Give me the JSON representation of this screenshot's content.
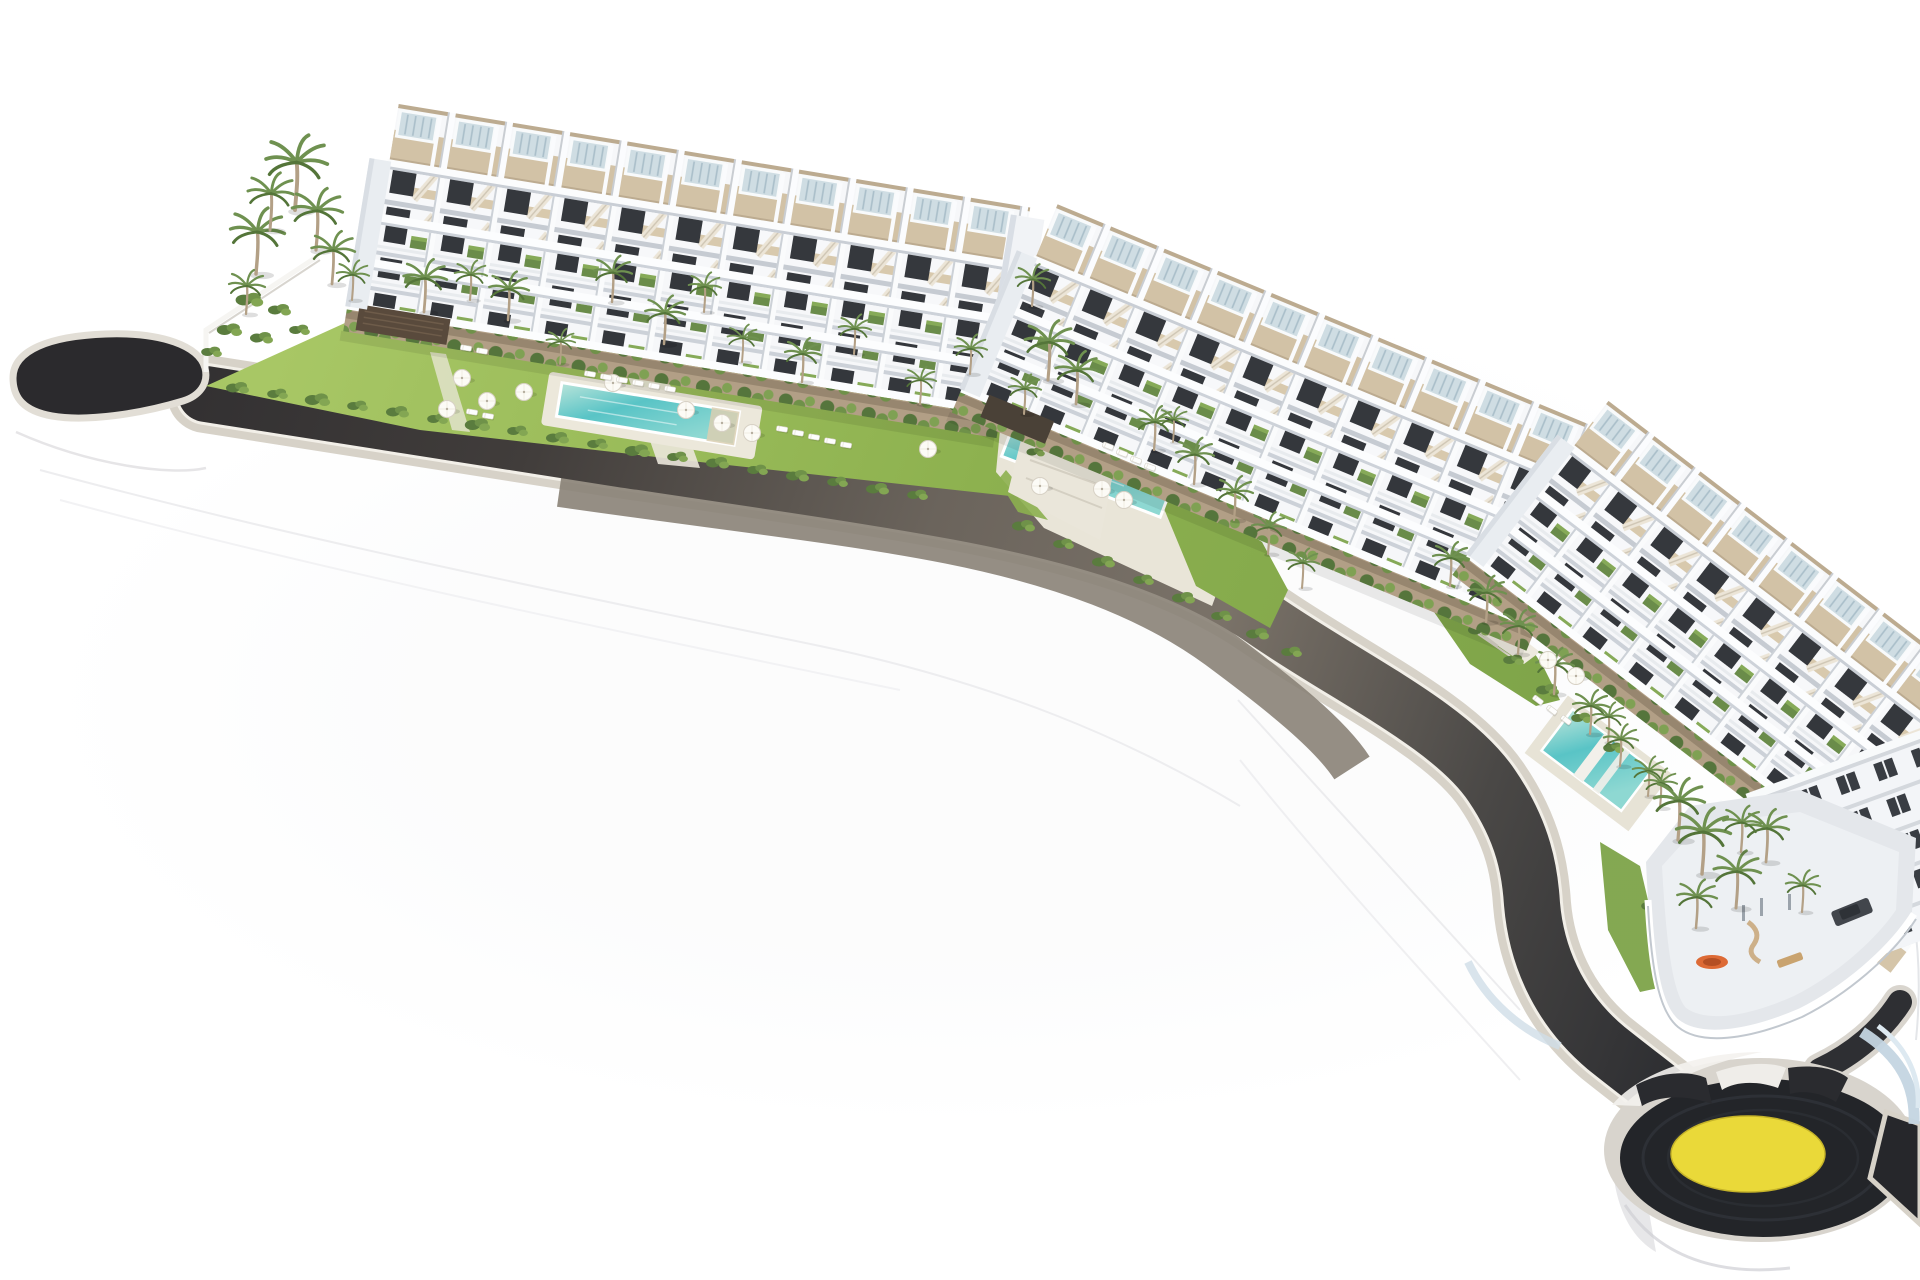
{
  "meta": {
    "description": "Aerial 3D architectural rendering of a coastal residential development: three white terraced apartment blocks with rooftop pergolas, gardens, swimming pools, palm trees, a dark curved access road on a white display plinth, and a roundabout with a yellow painted centre at the lower right.",
    "background": "#ffffff"
  },
  "colors": {
    "asphalt_dark": "#2b2a2d",
    "asphalt_mid": "#6b645c",
    "curb_beige": "#d7d2c8",
    "curb_white": "#f2efe8",
    "roundabout_yellow": "#eedd3a",
    "building_white": "#f6f7f9",
    "terrace_tan": "#d2c2a6",
    "window_dark": "#35383d",
    "lawn_green": "#8db14f",
    "lawn_light": "#a8c765",
    "pool_teal": "#59c4c6",
    "pool_light": "#b9e4da",
    "palm_green": "#6f9150",
    "shrub_green": "#5a7c3e",
    "stone_wall": "#b29f86",
    "deck_concrete": "#e4e7eb",
    "wall_blue": "#c4d5e1",
    "accent_orange": "#dd6a35",
    "car_dark": "#42464c"
  },
  "scene": {
    "road_label": "curved-access-road",
    "roundabout_label": "roundabout-yellow-centre",
    "blocks": [
      {
        "label": "terraced-block-left"
      },
      {
        "label": "terraced-block-middle"
      },
      {
        "label": "terraced-block-right"
      }
    ],
    "pools": [
      {
        "label": "pool-left-garden"
      },
      {
        "label": "pool-middle-garden"
      },
      {
        "label": "pool-right-garden"
      }
    ]
  },
  "sprites": {
    "palms": [
      {
        "x": 256,
        "y": 274,
        "s": 1.5
      },
      {
        "x": 270,
        "y": 230,
        "s": 1.3
      },
      {
        "x": 295,
        "y": 210,
        "s": 1.7
      },
      {
        "x": 316,
        "y": 250,
        "s": 1.4
      },
      {
        "x": 332,
        "y": 284,
        "s": 1.2
      },
      {
        "x": 246,
        "y": 314,
        "s": 1.0
      },
      {
        "x": 352,
        "y": 300,
        "s": 0.9
      },
      {
        "x": 424,
        "y": 312,
        "s": 1.2
      },
      {
        "x": 470,
        "y": 300,
        "s": 0.9
      },
      {
        "x": 508,
        "y": 320,
        "s": 1.1
      },
      {
        "x": 560,
        "y": 364,
        "s": 0.8
      },
      {
        "x": 612,
        "y": 302,
        "s": 1.05
      },
      {
        "x": 664,
        "y": 344,
        "s": 1.1
      },
      {
        "x": 704,
        "y": 312,
        "s": 0.9
      },
      {
        "x": 742,
        "y": 362,
        "s": 0.85
      },
      {
        "x": 802,
        "y": 382,
        "s": 1.0
      },
      {
        "x": 854,
        "y": 354,
        "s": 0.9
      },
      {
        "x": 920,
        "y": 404,
        "s": 0.85
      },
      {
        "x": 970,
        "y": 374,
        "s": 0.9
      },
      {
        "x": 1024,
        "y": 414,
        "s": 0.9
      },
      {
        "x": 1048,
        "y": 380,
        "s": 1.35
      },
      {
        "x": 1076,
        "y": 404,
        "s": 1.2
      },
      {
        "x": 1032,
        "y": 306,
        "s": 0.95
      },
      {
        "x": 1154,
        "y": 450,
        "s": 1.0
      },
      {
        "x": 1173,
        "y": 442,
        "s": 0.8
      },
      {
        "x": 1194,
        "y": 484,
        "s": 1.05
      },
      {
        "x": 1234,
        "y": 520,
        "s": 1.0
      },
      {
        "x": 1268,
        "y": 554,
        "s": 0.95
      },
      {
        "x": 1302,
        "y": 588,
        "s": 0.9
      },
      {
        "x": 1450,
        "y": 586,
        "s": 1.0
      },
      {
        "x": 1486,
        "y": 622,
        "s": 1.05
      },
      {
        "x": 1518,
        "y": 654,
        "s": 1.0
      },
      {
        "x": 1554,
        "y": 694,
        "s": 1.05
      },
      {
        "x": 1590,
        "y": 734,
        "s": 1.0
      },
      {
        "x": 1608,
        "y": 742,
        "s": 0.9
      },
      {
        "x": 1620,
        "y": 766,
        "s": 0.95
      },
      {
        "x": 1648,
        "y": 796,
        "s": 0.9
      },
      {
        "x": 1660,
        "y": 808,
        "s": 0.9
      },
      {
        "x": 1678,
        "y": 840,
        "s": 1.4
      },
      {
        "x": 1702,
        "y": 874,
        "s": 1.5
      },
      {
        "x": 1736,
        "y": 908,
        "s": 1.3
      },
      {
        "x": 1766,
        "y": 862,
        "s": 1.2
      },
      {
        "x": 1696,
        "y": 928,
        "s": 1.1
      },
      {
        "x": 1802,
        "y": 912,
        "s": 0.95
      },
      {
        "x": 1741,
        "y": 852,
        "s": 1.05
      }
    ],
    "umbrellas": [
      {
        "x": 462,
        "y": 378
      },
      {
        "x": 487,
        "y": 401
      },
      {
        "x": 447,
        "y": 409
      },
      {
        "x": 524,
        "y": 392
      },
      {
        "x": 613,
        "y": 383
      },
      {
        "x": 686,
        "y": 410
      },
      {
        "x": 722,
        "y": 423
      },
      {
        "x": 752,
        "y": 433
      },
      {
        "x": 928,
        "y": 449
      },
      {
        "x": 1040,
        "y": 486
      },
      {
        "x": 1102,
        "y": 489
      },
      {
        "x": 1124,
        "y": 500
      },
      {
        "x": 1548,
        "y": 660
      },
      {
        "x": 1576,
        "y": 676
      }
    ],
    "loungers": [
      {
        "x": 590,
        "y": 374,
        "a": 9
      },
      {
        "x": 606,
        "y": 377,
        "a": 9
      },
      {
        "x": 622,
        "y": 380,
        "a": 9
      },
      {
        "x": 638,
        "y": 383,
        "a": 9
      },
      {
        "x": 654,
        "y": 386,
        "a": 9
      },
      {
        "x": 670,
        "y": 389,
        "a": 9
      },
      {
        "x": 782,
        "y": 429,
        "a": 9
      },
      {
        "x": 798,
        "y": 433,
        "a": 9
      },
      {
        "x": 814,
        "y": 437,
        "a": 9
      },
      {
        "x": 830,
        "y": 441,
        "a": 9
      },
      {
        "x": 846,
        "y": 445,
        "a": 9
      },
      {
        "x": 472,
        "y": 412,
        "a": 9
      },
      {
        "x": 488,
        "y": 416,
        "a": 9
      },
      {
        "x": 466,
        "y": 348,
        "a": 9
      },
      {
        "x": 482,
        "y": 351,
        "a": 9
      },
      {
        "x": 1108,
        "y": 446,
        "a": 21
      },
      {
        "x": 1122,
        "y": 453,
        "a": 21
      },
      {
        "x": 1136,
        "y": 460,
        "a": 21
      },
      {
        "x": 1150,
        "y": 467,
        "a": 21
      },
      {
        "x": 1538,
        "y": 700,
        "a": 37
      },
      {
        "x": 1552,
        "y": 710,
        "a": 37
      },
      {
        "x": 1566,
        "y": 720,
        "a": 37
      }
    ],
    "shrubs": [
      {
        "x": 238,
        "y": 388,
        "s": 1.0
      },
      {
        "x": 278,
        "y": 394,
        "s": 0.9
      },
      {
        "x": 318,
        "y": 400,
        "s": 1.1
      },
      {
        "x": 358,
        "y": 406,
        "s": 0.9
      },
      {
        "x": 398,
        "y": 412,
        "s": 1.0
      },
      {
        "x": 438,
        "y": 419,
        "s": 0.9
      },
      {
        "x": 478,
        "y": 425,
        "s": 1.1
      },
      {
        "x": 518,
        "y": 431,
        "s": 0.9
      },
      {
        "x": 558,
        "y": 438,
        "s": 1.0
      },
      {
        "x": 598,
        "y": 444,
        "s": 0.9
      },
      {
        "x": 638,
        "y": 451,
        "s": 1.1
      },
      {
        "x": 678,
        "y": 457,
        "s": 0.9
      },
      {
        "x": 718,
        "y": 463,
        "s": 1.0
      },
      {
        "x": 758,
        "y": 470,
        "s": 0.9
      },
      {
        "x": 798,
        "y": 476,
        "s": 1.0
      },
      {
        "x": 838,
        "y": 482,
        "s": 0.9
      },
      {
        "x": 878,
        "y": 489,
        "s": 1.0
      },
      {
        "x": 918,
        "y": 495,
        "s": 0.9
      },
      {
        "x": 420,
        "y": 304,
        "s": 0.8
      },
      {
        "x": 470,
        "y": 312,
        "s": 0.9
      },
      {
        "x": 520,
        "y": 320,
        "s": 0.8
      },
      {
        "x": 570,
        "y": 328,
        "s": 0.9
      },
      {
        "x": 620,
        "y": 336,
        "s": 0.8
      },
      {
        "x": 670,
        "y": 344,
        "s": 0.9
      },
      {
        "x": 720,
        "y": 352,
        "s": 0.8
      },
      {
        "x": 770,
        "y": 360,
        "s": 0.9
      },
      {
        "x": 820,
        "y": 368,
        "s": 0.8
      },
      {
        "x": 870,
        "y": 376,
        "s": 0.9
      },
      {
        "x": 920,
        "y": 384,
        "s": 0.8
      },
      {
        "x": 970,
        "y": 392,
        "s": 0.9
      },
      {
        "x": 1015,
        "y": 399,
        "s": 0.8
      },
      {
        "x": 1024,
        "y": 526,
        "s": 1.0
      },
      {
        "x": 1064,
        "y": 544,
        "s": 0.9
      },
      {
        "x": 1104,
        "y": 562,
        "s": 1.0
      },
      {
        "x": 1144,
        "y": 580,
        "s": 0.9
      },
      {
        "x": 1184,
        "y": 598,
        "s": 1.0
      },
      {
        "x": 1222,
        "y": 616,
        "s": 0.9
      },
      {
        "x": 1258,
        "y": 634,
        "s": 1.0
      },
      {
        "x": 1292,
        "y": 652,
        "s": 0.9
      },
      {
        "x": 1446,
        "y": 602,
        "s": 0.9
      },
      {
        "x": 1480,
        "y": 630,
        "s": 1.0
      },
      {
        "x": 1514,
        "y": 660,
        "s": 0.9
      },
      {
        "x": 1548,
        "y": 690,
        "s": 1.0
      },
      {
        "x": 1582,
        "y": 718,
        "s": 0.9
      },
      {
        "x": 1614,
        "y": 748,
        "s": 0.9
      },
      {
        "x": 1652,
        "y": 906,
        "s": 0.9
      },
      {
        "x": 1660,
        "y": 948,
        "s": 0.8
      },
      {
        "x": 1670,
        "y": 986,
        "s": 0.9
      },
      {
        "x": 1700,
        "y": 1000,
        "s": 0.8
      },
      {
        "x": 250,
        "y": 300,
        "s": 1.2
      },
      {
        "x": 280,
        "y": 310,
        "s": 1.0
      },
      {
        "x": 230,
        "y": 330,
        "s": 1.1
      },
      {
        "x": 262,
        "y": 338,
        "s": 1.0
      },
      {
        "x": 300,
        "y": 330,
        "s": 0.9
      },
      {
        "x": 212,
        "y": 352,
        "s": 0.9
      },
      {
        "x": 1046,
        "y": 430,
        "s": 0.9
      },
      {
        "x": 1036,
        "y": 452,
        "s": 0.8
      }
    ]
  }
}
